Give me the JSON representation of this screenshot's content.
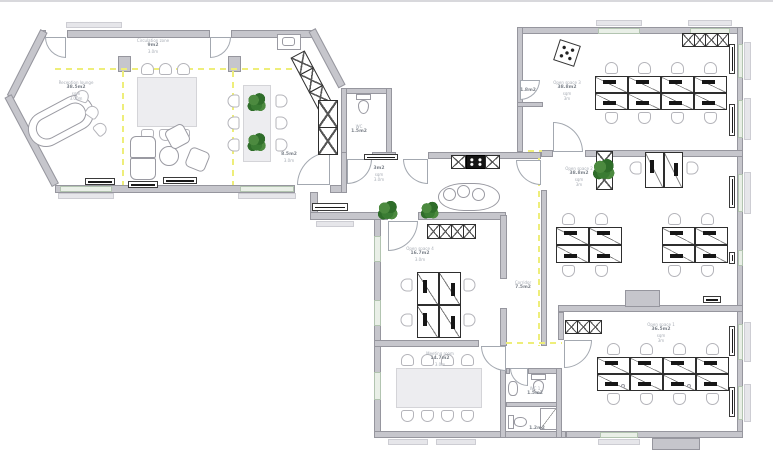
{
  "floor_plan": {
    "rooms": {
      "lounge": {
        "name": "Reception lounge",
        "area": "38.5m2",
        "unit": "sqm",
        "height": "3.00m"
      },
      "circulation": {
        "name": "Circulation zone",
        "area": "9m2",
        "unit": "sqm",
        "height": "3.0m"
      },
      "zone3": {
        "area": "8.5m2",
        "height": "3.0m"
      },
      "wc_small": {
        "name": "WC",
        "area": "1.5m2"
      },
      "entrance": {
        "area": "3m2",
        "unit": "sqm",
        "height": "3.0m"
      },
      "office": {
        "name": "Open space 4",
        "area": "16.7m2",
        "unit": "sqm",
        "height": "3.0m"
      },
      "corridor": {
        "name": "Corridor",
        "area": "7.5m2"
      },
      "meeting": {
        "name": "Meeting room",
        "area": "14.7m2",
        "unit": "sqm",
        "height": "3.0m"
      },
      "open_space_3": {
        "name": "Open space 3",
        "area": "38.8m2",
        "unit": "sqm",
        "height": "3m"
      },
      "open_space_2": {
        "name": "Open space 2",
        "area": "38.8m2",
        "unit": "sqm",
        "height": "3m"
      },
      "open_space_1": {
        "name": "Open space 1",
        "area": "36.5m2",
        "unit": "sqm",
        "height": "3m"
      },
      "wc_1": {
        "name": "WC 1",
        "area": "1.5m2"
      },
      "wc_2": {
        "name": "WC 2",
        "area": "1.2m2"
      },
      "vestibule": {
        "area": "1.8m2"
      }
    },
    "legend": {
      "wall_color": "#c6c6cc",
      "circulation_dash_color": "#eeee7a",
      "plant_color": "#3a7c33",
      "window_color": "#e9efe7"
    }
  }
}
